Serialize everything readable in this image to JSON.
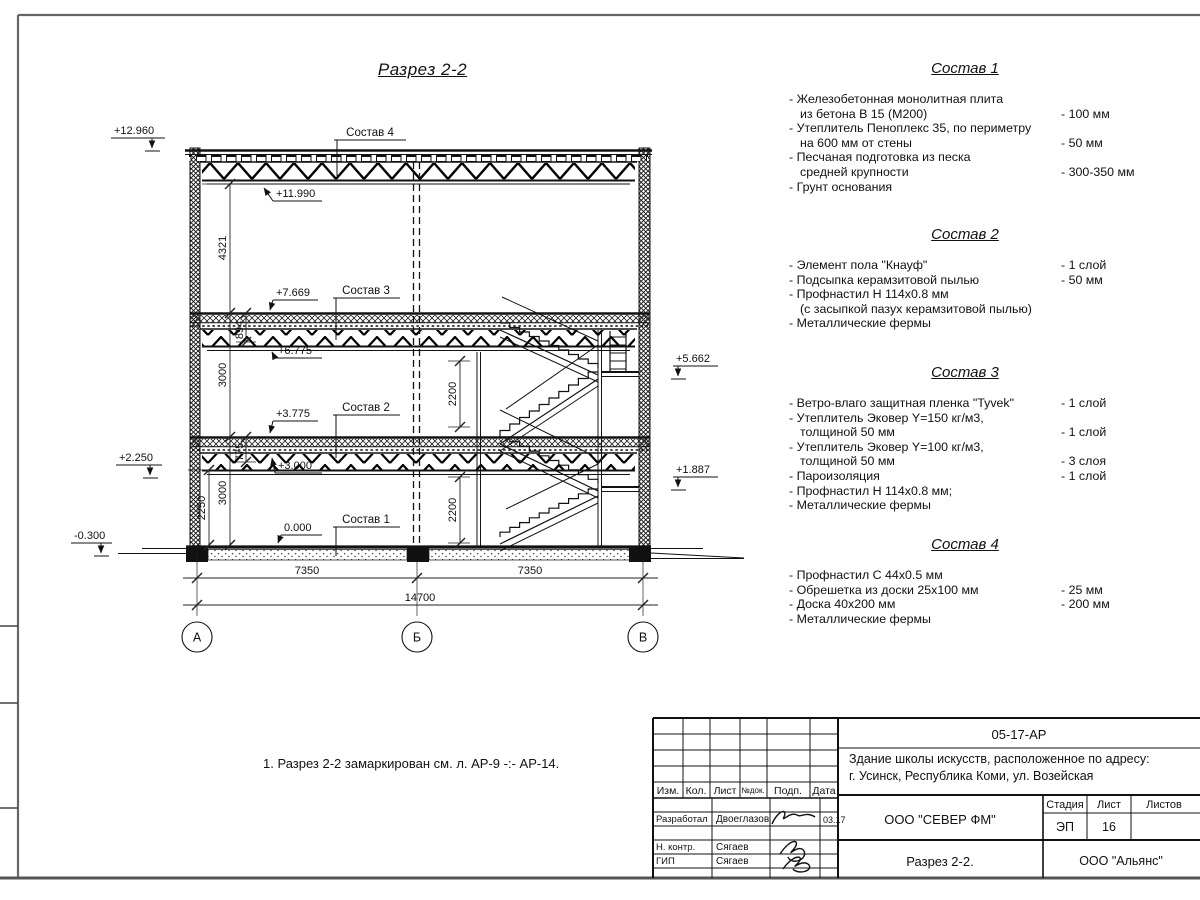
{
  "sheet": {
    "note": "1. Разрез 2-2 замаркирован см. л. АР-9 -:- АР-14."
  },
  "drawing": {
    "title": "Разрез 2-2",
    "callouts": {
      "c4": "Состав 4",
      "c3": "Состав 3",
      "c2": "Состав 2",
      "c1": "Состав 1"
    },
    "elevations": {
      "e12960": "+12.960",
      "e11990": "+11.990",
      "e7669": "+7.669",
      "e6775": "+6.775",
      "e3775": "+3.775",
      "e3000": "+3.000",
      "e0": "0.000",
      "e5662": "+5.662",
      "e1887": "+1.887",
      "e2250": "+2.250",
      "em0300": "-0.300"
    },
    "dims": {
      "d4321": "4321",
      "d894": "894",
      "d3000u": "3000",
      "d775": "775",
      "d3000l": "3000",
      "d2250": "2250",
      "d2200u": "2200",
      "d2200l": "2200",
      "d7350l": "7350",
      "d7350r": "7350",
      "d14700": "14700"
    },
    "axes": {
      "a": "А",
      "b": "Б",
      "v": "В"
    }
  },
  "compositions": [
    {
      "title": "Состав 1",
      "items": [
        {
          "lines": [
            "- Железобетонная  монолитная плита",
            "из бетона В 15 (М200)"
          ],
          "value": "- 100 мм"
        },
        {
          "lines": [
            "- Утеплитель Пеноплекс 35, по периметру",
            "на 600 мм от стены"
          ],
          "value": "- 50 мм"
        },
        {
          "lines": [
            "- Песчаная подготовка из песка",
            "средней крупности"
          ],
          "value": "- 300-350 мм"
        },
        {
          "lines": [
            "- Грунт основания"
          ],
          "value": ""
        }
      ]
    },
    {
      "title": "Состав 2",
      "items": [
        {
          "lines": [
            "- Элемент пола \"Кнауф\""
          ],
          "value": "- 1 слой"
        },
        {
          "lines": [
            "- Подсыпка керамзитовой пылью"
          ],
          "value": "- 50 мм"
        },
        {
          "lines": [
            "- Профнастил Н 114х0.8 мм",
            "(с засыпкой пазух керамзитовой пылью)"
          ],
          "value": ""
        },
        {
          "lines": [
            "- Металлические фермы"
          ],
          "value": ""
        }
      ]
    },
    {
      "title": "Состав 3",
      "items": [
        {
          "lines": [
            "- Ветро-влаго защитная пленка  \"Tyvek\""
          ],
          "value": "- 1 слой"
        },
        {
          "lines": [
            "- Утеплитель Эковер Y=150 кг/м3,",
            "толщиной 50 мм"
          ],
          "value": "- 1 слой"
        },
        {
          "lines": [
            "- Утеплитель Эковер Y=100 кг/м3,",
            "толщиной 50 мм"
          ],
          "value": "- 3 слоя"
        },
        {
          "lines": [
            "- Пароизоляция"
          ],
          "value": "- 1 слой"
        },
        {
          "lines": [
            "- Профнастил Н 114х0.8 мм;"
          ],
          "value": ""
        },
        {
          "lines": [
            "- Металлические фермы"
          ],
          "value": ""
        }
      ]
    },
    {
      "title": "Состав 4",
      "items": [
        {
          "lines": [
            "- Профнастил С 44х0.5 мм"
          ],
          "value": ""
        },
        {
          "lines": [
            "- Обрешетка из доски 25х100 мм"
          ],
          "value": "- 25 мм"
        },
        {
          "lines": [
            "- Доска 40х200 мм"
          ],
          "value": "- 200 мм"
        },
        {
          "lines": [
            "- Металлические фермы"
          ],
          "value": ""
        }
      ]
    }
  ],
  "titleblock": {
    "doc_number": "05-17-АР",
    "project_line1": "Здание школы искусств, расположенное по адресу:",
    "project_line2": "г. Усинск, Республика Коми, ул. Возейская",
    "cols": {
      "izm": "Изм.",
      "kol": "Кол.",
      "list": "Лист",
      "ndok": "№док.",
      "podp": "Подп.",
      "data": "Дата"
    },
    "rows": [
      {
        "role": "Разработал",
        "name": "Двоеглазов",
        "date": "03.17"
      },
      {
        "role": "Н. контр.",
        "name": "Сягаев",
        "date": ""
      },
      {
        "role": "ГИП",
        "name": "Сягаев",
        "date": ""
      }
    ],
    "company": "ООО \"СЕВЕР ФМ\"",
    "stage_label": "Стадия",
    "sheet_label": "Лист",
    "sheets_label": "Листов",
    "stage": "ЭП",
    "sheet_no": "16",
    "sheets_total": "",
    "sheet_title": "Разрез 2-2.",
    "contractor": "ООО \"Альянс\""
  }
}
